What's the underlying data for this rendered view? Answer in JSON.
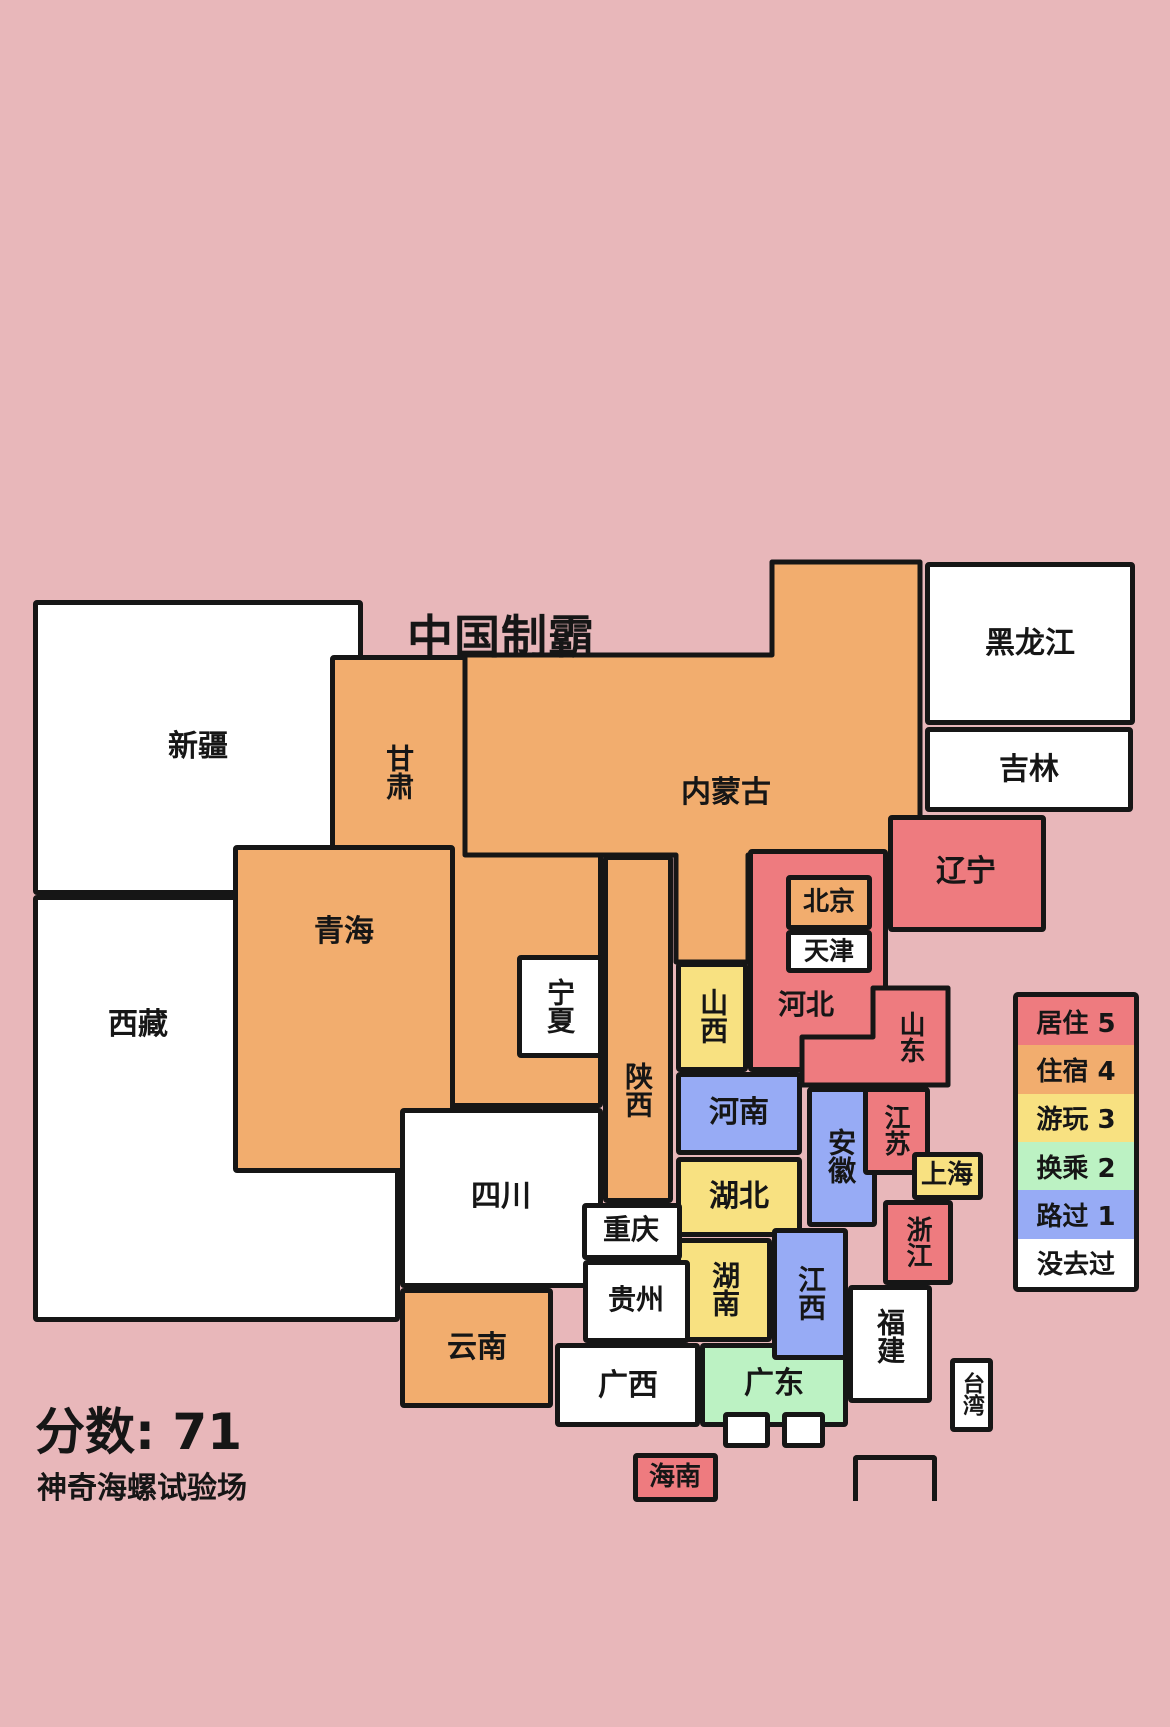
{
  "title": "中国制霸",
  "score_text": "分数: 71",
  "subtitle": "神奇海螺试验场",
  "background_color": "#E8B7BA",
  "border_color": "#161616",
  "text_color": "#161616",
  "status_colors": {
    "5": "#EE7B7F",
    "4": "#F2AD6E",
    "3": "#F8E181",
    "2": "#BCF2C3",
    "1": "#97ABF5",
    "0": "#FFFFFF"
  },
  "legend": {
    "x": 1013,
    "y": 992,
    "w": 126,
    "h": 300,
    "items": [
      {
        "label": "居住 5",
        "status": "5"
      },
      {
        "label": "住宿 4",
        "status": "4"
      },
      {
        "label": "游玩 3",
        "status": "3"
      },
      {
        "label": "换乘 2",
        "status": "2"
      },
      {
        "label": "路过 1",
        "status": "1"
      },
      {
        "label": "没去过",
        "status": "0"
      }
    ]
  },
  "title_pos": {
    "x": 501,
    "y": 634,
    "size": 46
  },
  "score_pos": {
    "x": 35,
    "y": 1392,
    "size": 50
  },
  "subtitle_pos": {
    "x": 37,
    "y": 1463,
    "size": 30
  },
  "regions": [
    {
      "id": "xinjiang",
      "name": "新疆",
      "status": "0",
      "x": 33,
      "y": 600,
      "w": 330,
      "h": 295,
      "z": 0,
      "lx": 198,
      "ly": 747,
      "vertical": false,
      "fs": 30
    },
    {
      "id": "xizang",
      "name": "西藏",
      "status": "0",
      "x": 33,
      "y": 895,
      "w": 367,
      "h": 427,
      "z": 0,
      "lx": 138,
      "ly": 1025,
      "vertical": false,
      "fs": 30
    },
    {
      "id": "gansu",
      "name": "甘肃",
      "status": "4",
      "x": 330,
      "y": 655,
      "w": 273,
      "h": 453,
      "z": 1,
      "lx": 398,
      "ly": 772,
      "vertical": true,
      "fs": 28
    },
    {
      "id": "heilongjiang",
      "name": "黑龙江",
      "status": "0",
      "x": 925,
      "y": 562,
      "w": 210,
      "h": 163,
      "z": 1,
      "lx": 1030,
      "ly": 644,
      "vertical": false,
      "fs": 30
    },
    {
      "id": "jilin",
      "name": "吉林",
      "status": "0",
      "x": 925,
      "y": 727,
      "w": 208,
      "h": 85,
      "z": 1,
      "lx": 1029,
      "ly": 770,
      "vertical": false,
      "fs": 30
    },
    {
      "id": "shanxi",
      "name": "山西",
      "status": "3",
      "x": 676,
      "y": 962,
      "w": 72,
      "h": 110,
      "z": 1,
      "lx": 712,
      "ly": 1016,
      "vertical": true,
      "fs": 28
    },
    {
      "id": "henan",
      "name": "河南",
      "status": "1",
      "x": 676,
      "y": 1072,
      "w": 126,
      "h": 83,
      "z": 1,
      "lx": 739,
      "ly": 1113,
      "vertical": false,
      "fs": 30
    },
    {
      "id": "hubei",
      "name": "湖北",
      "status": "3",
      "x": 676,
      "y": 1157,
      "w": 126,
      "h": 80,
      "z": 1,
      "lx": 739,
      "ly": 1197,
      "vertical": false,
      "fs": 30
    },
    {
      "id": "hunan",
      "name": "湖南",
      "status": "3",
      "x": 676,
      "y": 1238,
      "w": 96,
      "h": 104,
      "z": 1,
      "lx": 724,
      "ly": 1289,
      "vertical": true,
      "fs": 28
    },
    {
      "id": "guangxi",
      "name": "广西",
      "status": "0",
      "x": 555,
      "y": 1343,
      "w": 145,
      "h": 84,
      "z": 1,
      "lx": 628,
      "ly": 1386,
      "vertical": false,
      "fs": 30
    },
    {
      "id": "guangdong",
      "name": "广东",
      "status": "2",
      "x": 700,
      "y": 1343,
      "w": 148,
      "h": 84,
      "z": 1,
      "lx": 774,
      "ly": 1384,
      "vertical": false,
      "fs": 30
    },
    {
      "id": "anhui",
      "name": "安徽",
      "status": "1",
      "x": 807,
      "y": 1087,
      "w": 70,
      "h": 140,
      "z": 1,
      "lx": 840,
      "ly": 1156,
      "vertical": true,
      "fs": 28
    },
    {
      "id": "yunnan",
      "name": "云南",
      "status": "4",
      "x": 400,
      "y": 1288,
      "w": 153,
      "h": 120,
      "z": 1,
      "lx": 477,
      "ly": 1348,
      "vertical": false,
      "fs": 30
    },
    {
      "id": "neimenggu",
      "name": "内蒙古",
      "status": "4",
      "x": 465,
      "y": 562,
      "w": 455,
      "h": 400,
      "z": 2,
      "lx": 726,
      "ly": 793,
      "vertical": false,
      "fs": 30,
      "points": "0,93 307,93 307,0 455,0 455,293 283,293 283,400 211,400 211,293 0,293"
    },
    {
      "id": "shaanxi",
      "name": "陕西",
      "status": "4",
      "x": 603,
      "y": 855,
      "w": 70,
      "h": 348,
      "z": 2,
      "lx": 637,
      "ly": 1090,
      "vertical": true,
      "fs": 28
    },
    {
      "id": "hebei",
      "name": "河北",
      "status": "5",
      "x": 748,
      "y": 849,
      "w": 140,
      "h": 223,
      "z": 2,
      "lx": 806,
      "ly": 1005,
      "vertical": false,
      "fs": 28
    },
    {
      "id": "jiangsu",
      "name": "江苏",
      "status": "5",
      "x": 863,
      "y": 1087,
      "w": 67,
      "h": 88,
      "z": 2,
      "lx": 895,
      "ly": 1130,
      "vertical": true,
      "fs": 26
    },
    {
      "id": "zhejiang",
      "name": "浙江",
      "status": "5",
      "x": 883,
      "y": 1200,
      "w": 70,
      "h": 85,
      "z": 2,
      "lx": 917,
      "ly": 1242,
      "vertical": true,
      "fs": 26
    },
    {
      "id": "fujian",
      "name": "福建",
      "status": "0",
      "x": 848,
      "y": 1285,
      "w": 84,
      "h": 118,
      "z": 2,
      "lx": 889,
      "ly": 1336,
      "vertical": true,
      "fs": 28
    },
    {
      "id": "taiwan",
      "name": "台湾",
      "status": "0",
      "x": 950,
      "y": 1358,
      "w": 43,
      "h": 74,
      "z": 2,
      "lx": 971,
      "ly": 1394,
      "vertical": true,
      "fs": 22
    },
    {
      "id": "jiangxi",
      "name": "江西",
      "status": "1",
      "x": 772,
      "y": 1228,
      "w": 76,
      "h": 132,
      "z": 2,
      "lx": 810,
      "ly": 1293,
      "vertical": true,
      "fs": 28
    },
    {
      "id": "hainan",
      "name": "海南",
      "status": "5",
      "x": 633,
      "y": 1453,
      "w": 85,
      "h": 49,
      "z": 2,
      "lx": 675,
      "ly": 1477,
      "vertical": false,
      "fs": 26
    },
    {
      "id": "qinghai",
      "name": "青海",
      "status": "4",
      "x": 233,
      "y": 845,
      "w": 222,
      "h": 328,
      "z": 3,
      "lx": 344,
      "ly": 932,
      "vertical": false,
      "fs": 30
    },
    {
      "id": "beijing",
      "name": "北京",
      "status": "4",
      "x": 786,
      "y": 875,
      "w": 86,
      "h": 55,
      "z": 3,
      "lx": 829,
      "ly": 902,
      "vertical": false,
      "fs": 26
    },
    {
      "id": "tianjin",
      "name": "天津",
      "status": "0",
      "x": 786,
      "y": 930,
      "w": 86,
      "h": 43,
      "z": 3,
      "lx": 829,
      "ly": 951,
      "vertical": false,
      "fs": 25
    },
    {
      "id": "shandong",
      "name": "山东",
      "status": "5",
      "x": 802,
      "y": 988,
      "w": 146,
      "h": 97,
      "z": 3,
      "lx": 910,
      "ly": 1037,
      "vertical": true,
      "fs": 26,
      "points": "71,0 146,0 146,97 0,97 0,49 71,49"
    },
    {
      "id": "liaoning",
      "name": "辽宁",
      "status": "5",
      "x": 888,
      "y": 815,
      "w": 158,
      "h": 117,
      "z": 3,
      "lx": 966,
      "ly": 872,
      "vertical": false,
      "fs": 30
    },
    {
      "id": "sichuan",
      "name": "四川",
      "status": "0",
      "x": 400,
      "y": 1108,
      "w": 203,
      "h": 180,
      "z": 4,
      "lx": 501,
      "ly": 1197,
      "vertical": false,
      "fs": 30
    },
    {
      "id": "ningxia",
      "name": "宁夏",
      "status": "0",
      "x": 517,
      "y": 955,
      "w": 86,
      "h": 103,
      "z": 4,
      "lx": 559,
      "ly": 1006,
      "vertical": true,
      "fs": 28
    },
    {
      "id": "shanghai",
      "name": "上海",
      "status": "3",
      "x": 912,
      "y": 1152,
      "w": 71,
      "h": 48,
      "z": 4,
      "lx": 947,
      "ly": 1175,
      "vertical": false,
      "fs": 26
    },
    {
      "id": "chongqing",
      "name": "重庆",
      "status": "0",
      "x": 582,
      "y": 1203,
      "w": 100,
      "h": 57,
      "z": 5,
      "lx": 631,
      "ly": 1230,
      "vertical": false,
      "fs": 28
    },
    {
      "id": "guizhou",
      "name": "贵州",
      "status": "0",
      "x": 583,
      "y": 1260,
      "w": 107,
      "h": 83,
      "z": 5,
      "lx": 636,
      "ly": 1300,
      "vertical": false,
      "fs": 28
    },
    {
      "id": "hongkong",
      "name": "",
      "status": "0",
      "x": 723,
      "y": 1412,
      "w": 47,
      "h": 36,
      "z": 5,
      "lx": 746,
      "ly": 1430,
      "vertical": false,
      "fs": 20
    },
    {
      "id": "macau",
      "name": "",
      "status": "0",
      "x": 782,
      "y": 1412,
      "w": 43,
      "h": 36,
      "z": 5,
      "lx": 803,
      "ly": 1430,
      "vertical": false,
      "fs": 20
    }
  ],
  "sea_bracket": {
    "x": 853,
    "y": 1455,
    "w": 84,
    "h": 46
  }
}
